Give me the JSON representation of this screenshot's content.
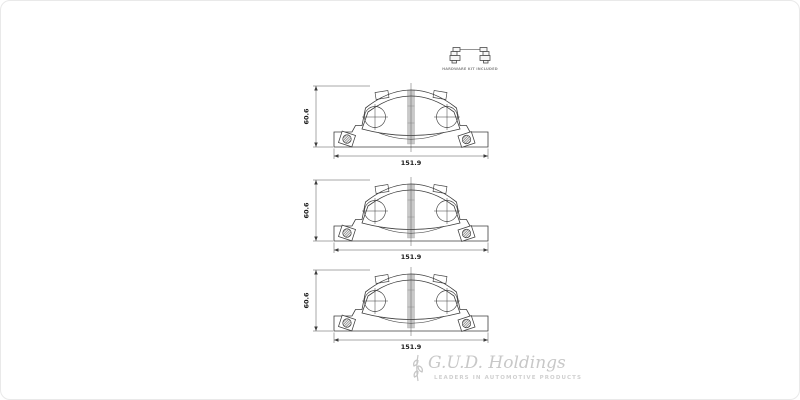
{
  "window": {
    "background": "#ffffff",
    "border_color": "#e9e9e9",
    "description": "Brake pad set technical drawing, three identical front views with dimensions, plus hardware kit thumbnail"
  },
  "hardware_kit": {
    "caption": "HARDWARE KIT INCLUDED"
  },
  "diagrams": [
    {
      "view": "brake-pad-front-view",
      "width_mm": "151.9",
      "height_mm": "60.6"
    },
    {
      "view": "brake-pad-front-view",
      "width_mm": "151.9",
      "height_mm": "60.6"
    },
    {
      "view": "brake-pad-front-view",
      "width_mm": "151.9",
      "height_mm": "60.6"
    }
  ],
  "logo": {
    "company": "G.U.D. Holdings",
    "tagline": "LEADERS IN AUTOMOTIVE PRODUCTS"
  },
  "colors": {
    "drawing_line": "#3d3d3d",
    "slot_fill": "#c9c9c9",
    "dimension_text": "#1a1a1a",
    "logo_text": "#c8c8c8",
    "logo_tagline": "#d0d0d0"
  }
}
